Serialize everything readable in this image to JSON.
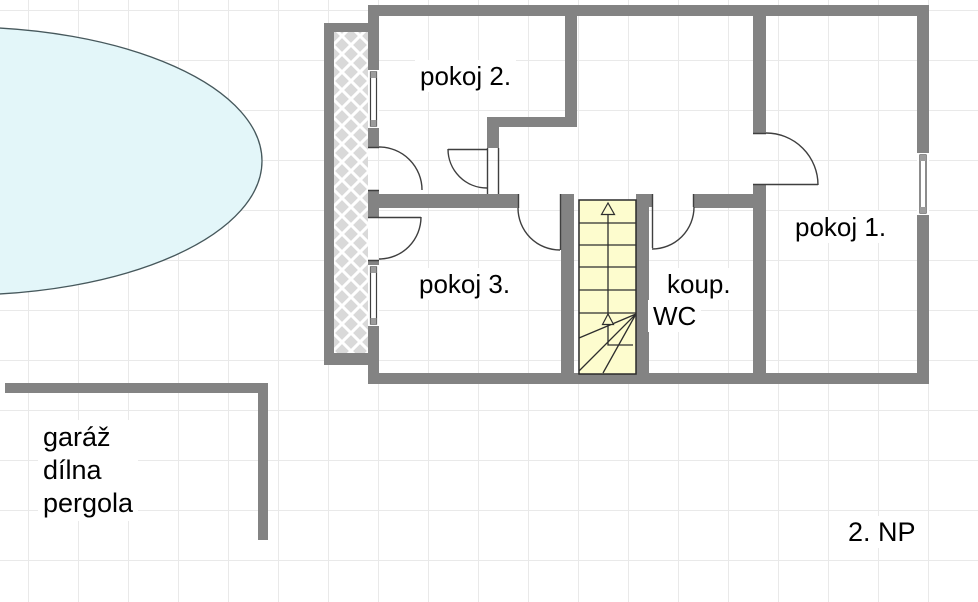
{
  "labels": {
    "room2": "pokoj 2.",
    "room1": "pokoj 1.",
    "room3": "pokoj 3.",
    "bath_line1": "koup.",
    "bath_line2": "WC",
    "outbuilding_line1": "garáž",
    "outbuilding_line2": "dílna",
    "outbuilding_line3": "pergola",
    "floor": "2. NP"
  },
  "colors": {
    "background": "#ffffff",
    "grid": "#e9e9e9",
    "wall": "#838383",
    "line": "#3f3f3f",
    "stairs_fill": "#fdfcce",
    "stairs_stroke": "#2b2b2b",
    "hatch_fill": "#d9d9d9",
    "hatch_line": "#ffffff",
    "ellipse_fill": "#e3f6f9",
    "ellipse_stroke": "#46585c",
    "text": "#000000"
  }
}
